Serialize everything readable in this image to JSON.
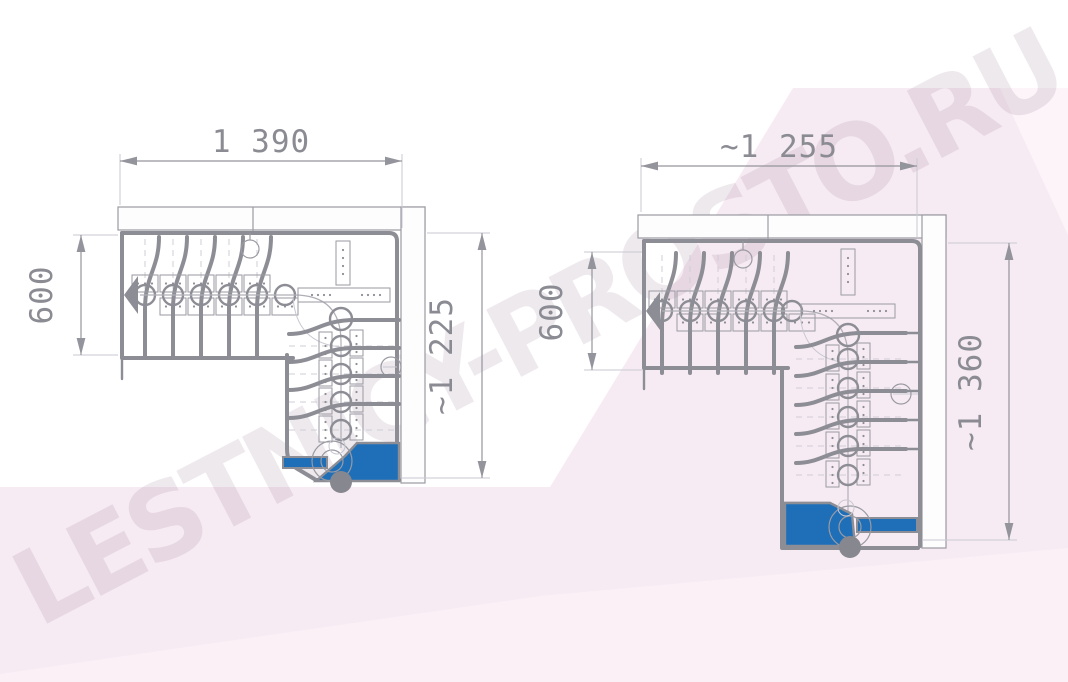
{
  "watermark": {
    "text": "LESTNICY-PROSTO.RU"
  },
  "left_drawing": {
    "dim_width_top": "1 390",
    "dim_depth_left": "600",
    "dim_length_right": "~1 225"
  },
  "right_drawing": {
    "dim_width_top": "~1 255",
    "dim_depth_left": "600",
    "dim_length_right": "~1 360"
  },
  "colors": {
    "drawing_line": "#8d8d95",
    "step_highlight": "#1e6fb8",
    "dimension_text": "#8b8b93",
    "background_pink": "#f7ebf3",
    "watermark": "#e9dce6"
  }
}
